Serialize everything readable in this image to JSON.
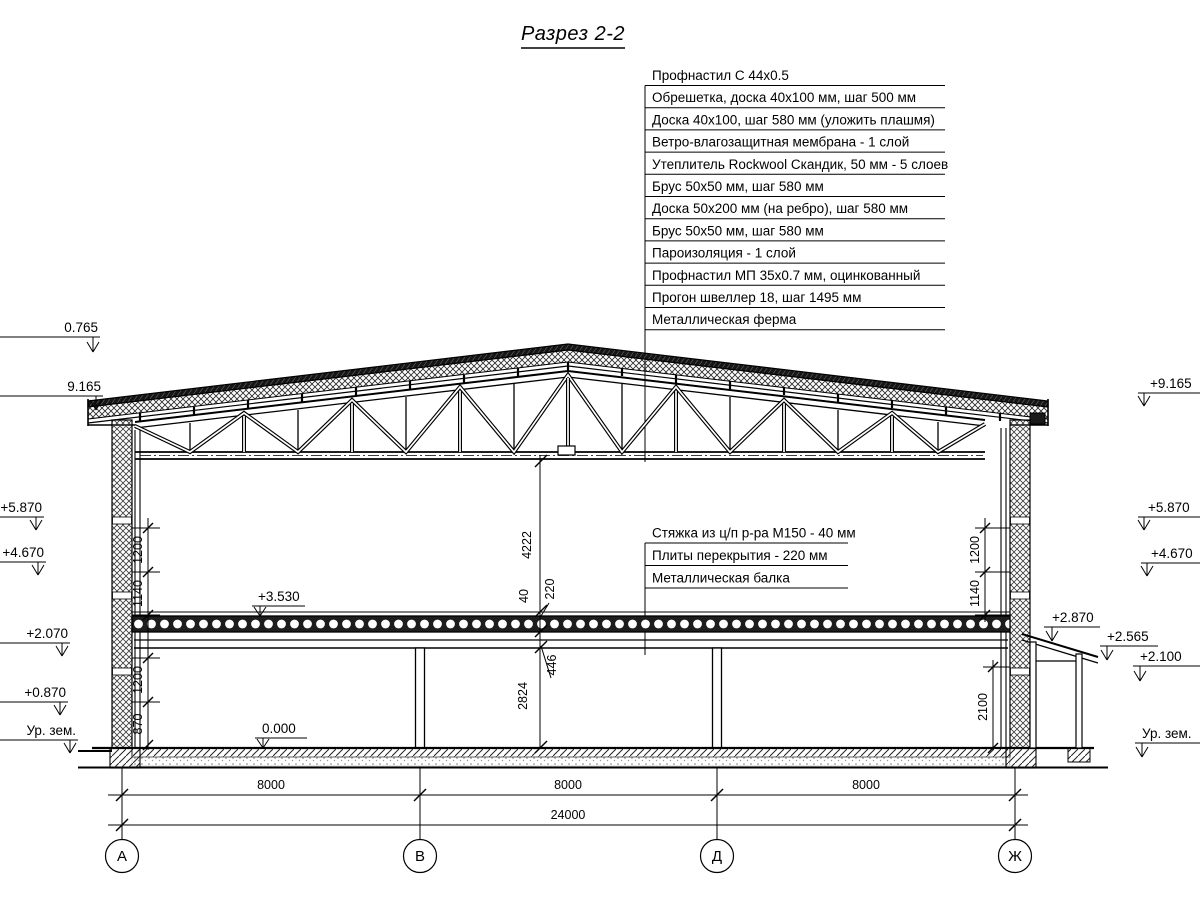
{
  "title": "Разрез 2-2",
  "roof_callouts": {
    "items": [
      "Профнастил С 44х0.5",
      "Обрешетка, доска 40х100 мм, шаг 500 мм",
      "Доска 40х100, шаг 580 мм (уложить плашмя)",
      "Ветро-влагозащитная мембрана - 1 слой",
      "Утеплитель Rockwool Скандик, 50 мм - 5 слоев",
      "Брус 50х50 мм, шаг 580 мм",
      "Доска 50х200 мм (на ребро), шаг 580 мм",
      "Брус 50х50 мм, шаг 580 мм",
      "Пароизоляция - 1 слой",
      "Профнастил МП 35х0.7 мм, оцинкованный",
      "Прогон швеллер 18, шаг 1495 мм",
      "Металлическая ферма"
    ]
  },
  "floor_callouts": {
    "items": [
      "Стяжка из ц/п р-ра М150 - 40 мм",
      "Плиты перекрытия - 220 мм",
      "Металлическая балка"
    ]
  },
  "levels": {
    "left": [
      "0.765",
      "9.165",
      "+5.870",
      "+4.670",
      "+2.070",
      "+0.870",
      "Ур. зем."
    ],
    "right": [
      "+9.165",
      "+5.870",
      "+4.670",
      "+2.870",
      "+2.565",
      "+2.100",
      "Ур. зем."
    ],
    "floor2": "+3.530",
    "floor1": "0.000"
  },
  "dims": {
    "center": [
      "4222",
      "40",
      "220",
      "446",
      "2824"
    ],
    "left": [
      "1200",
      "1140",
      "1200",
      "870"
    ],
    "right": [
      "1200",
      "1140",
      "2100"
    ],
    "spans": [
      "8000",
      "8000",
      "8000"
    ],
    "total": "24000"
  },
  "axes": [
    "А",
    "В",
    "Д",
    "Ж"
  ]
}
